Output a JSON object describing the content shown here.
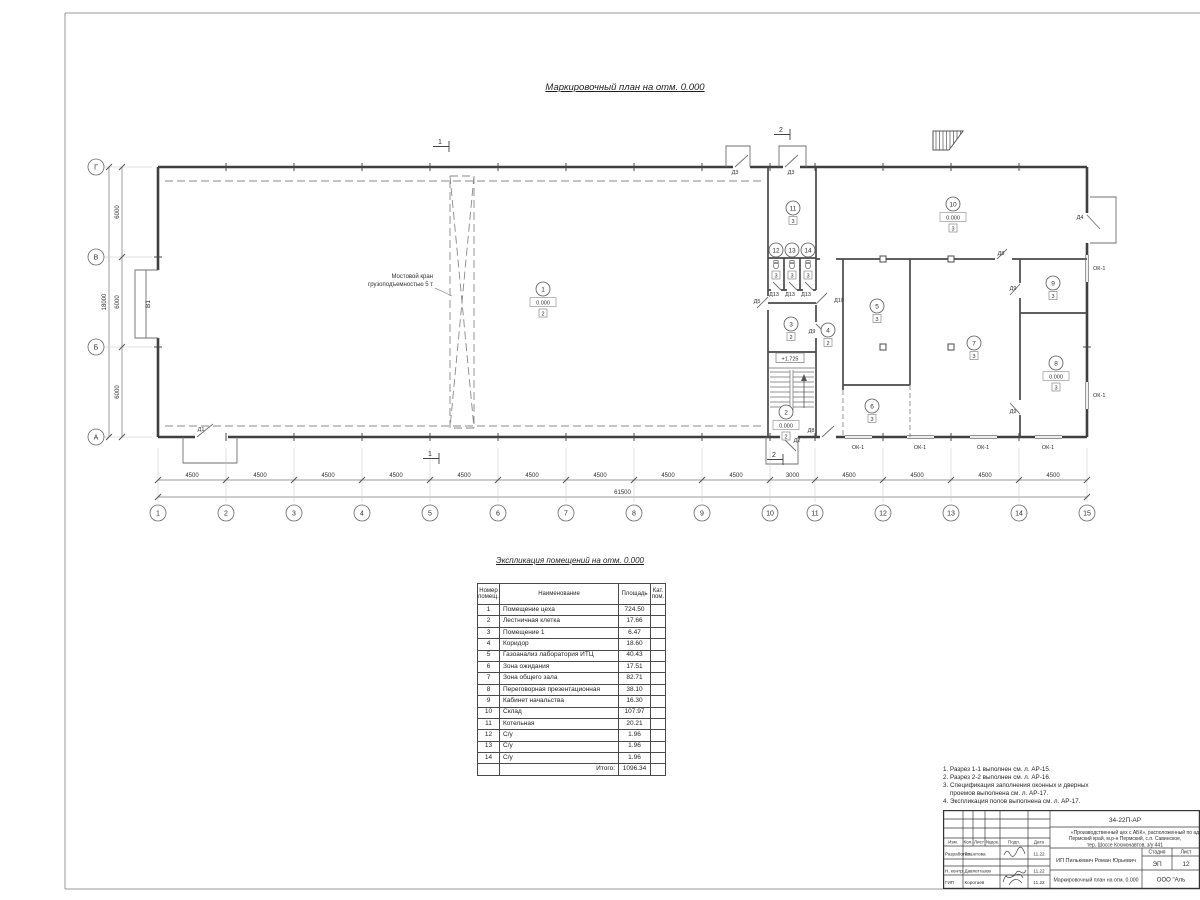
{
  "titles": {
    "plan_title": "Маркировочный план  на отм. 0.000",
    "table_title": "Экспликация помещений на отм. 0.000"
  },
  "plan": {
    "crane_label_lines": [
      "Мостовой кран",
      "грузоподъемностью 5 т"
    ],
    "level_mark": "+1.725",
    "gate_label": "В1",
    "grid_cols": [
      {
        "label": "1",
        "x": 158
      },
      {
        "label": "2",
        "x": 226
      },
      {
        "label": "3",
        "x": 294
      },
      {
        "label": "4",
        "x": 362
      },
      {
        "label": "5",
        "x": 430
      },
      {
        "label": "6",
        "x": 498
      },
      {
        "label": "7",
        "x": 566
      },
      {
        "label": "8",
        "x": 634
      },
      {
        "label": "9",
        "x": 702
      },
      {
        "label": "10",
        "x": 770
      },
      {
        "label": "11",
        "x": 815
      },
      {
        "label": "12",
        "x": 883
      },
      {
        "label": "13",
        "x": 951
      },
      {
        "label": "14",
        "x": 1019
      },
      {
        "label": "15",
        "x": 1087
      }
    ],
    "grid_rows": [
      {
        "label": "Г",
        "y": 167
      },
      {
        "label": "В",
        "y": 257
      },
      {
        "label": "Б",
        "y": 347
      },
      {
        "label": "А",
        "y": 437
      }
    ],
    "dim_bottom_segments": [
      "4500",
      "4500",
      "4500",
      "4500",
      "4500",
      "4500",
      "4500",
      "4500",
      "4500",
      "3000",
      "4500",
      "4500",
      "4500",
      "4500"
    ],
    "dim_bottom_total": "61500",
    "dim_left_segments": [
      "6000",
      "6000",
      "6000"
    ],
    "dim_left_total": "18000",
    "rooms": [
      {
        "n": "1",
        "x": 543,
        "y": 289,
        "elev": "0.000",
        "cat": "2"
      },
      {
        "n": "2",
        "x": 786,
        "y": 412,
        "elev": "0.000",
        "cat": "2"
      },
      {
        "n": "3",
        "x": 791,
        "y": 324,
        "cat": "2"
      },
      {
        "n": "4",
        "x": 828,
        "y": 330,
        "cat": "2"
      },
      {
        "n": "5",
        "x": 877,
        "y": 306,
        "cat": "3"
      },
      {
        "n": "6",
        "x": 872,
        "y": 406,
        "cat": "3"
      },
      {
        "n": "7",
        "x": 974,
        "y": 343,
        "cat": "3"
      },
      {
        "n": "8",
        "x": 1056,
        "y": 363,
        "elev": "0.000",
        "cat": "3"
      },
      {
        "n": "9",
        "x": 1053,
        "y": 283,
        "cat": "3"
      },
      {
        "n": "10",
        "x": 953,
        "y": 204,
        "elev": "0.000",
        "cat": "3"
      },
      {
        "n": "11",
        "x": 793,
        "y": 208,
        "cat": "3"
      },
      {
        "n": "12",
        "x": 776,
        "y": 250,
        "cat": "3",
        "wc": true
      },
      {
        "n": "13",
        "x": 792,
        "y": 250,
        "cat": "3",
        "wc": true
      },
      {
        "n": "14",
        "x": 808,
        "y": 250,
        "cat": "3",
        "wc": true
      }
    ],
    "doors": [
      {
        "t": "Д1",
        "x": 201,
        "y": 431
      },
      {
        "t": "Д3",
        "x": 735,
        "y": 174
      },
      {
        "t": "Д3",
        "x": 791,
        "y": 174
      },
      {
        "t": "Д4",
        "x": 1080,
        "y": 219
      },
      {
        "t": "Д5",
        "x": 757,
        "y": 303
      },
      {
        "t": "Д8",
        "x": 1001,
        "y": 255
      },
      {
        "t": "Д8",
        "x": 811,
        "y": 432
      },
      {
        "t": "Д9",
        "x": 812,
        "y": 333
      },
      {
        "t": "Д9",
        "x": 1013,
        "y": 290
      },
      {
        "t": "Д9",
        "x": 1013,
        "y": 413
      },
      {
        "t": "Д10",
        "x": 839,
        "y": 302
      },
      {
        "t": "Д13",
        "x": 774,
        "y": 296
      },
      {
        "t": "Д13",
        "x": 790,
        "y": 296
      },
      {
        "t": "Д13",
        "x": 806,
        "y": 296
      },
      {
        "t": "Д2",
        "x": 797,
        "y": 442
      }
    ],
    "windows": [
      {
        "t": "ОК-1",
        "x": 858,
        "y": 449,
        "a": "m"
      },
      {
        "t": "ОК-1",
        "x": 920,
        "y": 449,
        "a": "m"
      },
      {
        "t": "ОК-1",
        "x": 983,
        "y": 449,
        "a": "m"
      },
      {
        "t": "ОК-1",
        "x": 1048,
        "y": 449,
        "a": "m"
      },
      {
        "t": "ОК-1",
        "x": 1093,
        "y": 270,
        "a": "s"
      },
      {
        "t": "ОК-1",
        "x": 1093,
        "y": 397,
        "a": "s"
      }
    ],
    "sections": [
      {
        "n": "1",
        "x": 440,
        "y": 144
      },
      {
        "n": "1",
        "x": 430,
        "y": 456
      },
      {
        "n": "2",
        "x": 781,
        "y": 132
      },
      {
        "n": "2",
        "x": 774,
        "y": 457
      }
    ]
  },
  "table": {
    "headers": [
      "Номер помещ.",
      "Наименование",
      "Площадь",
      "Кат. пом."
    ],
    "rows": [
      [
        "1",
        "Помещение цеха",
        "724.50",
        ""
      ],
      [
        "2",
        "Лестничная клетка",
        "17.66",
        ""
      ],
      [
        "3",
        "Помещение 1",
        "6.47",
        ""
      ],
      [
        "4",
        "Коридор",
        "18.60",
        ""
      ],
      [
        "5",
        "Газоанализ лаборатория ИТЦ",
        "40.43",
        ""
      ],
      [
        "6",
        "Зона ожидания",
        "17.51",
        ""
      ],
      [
        "7",
        "Зона общего зала",
        "82.71",
        ""
      ],
      [
        "8",
        "Переговорная презентационная",
        "38.10",
        ""
      ],
      [
        "9",
        "Кабинет начальства",
        "16.30",
        ""
      ],
      [
        "10",
        "Склад",
        "107.97",
        ""
      ],
      [
        "11",
        "Котельная",
        "20.21",
        ""
      ],
      [
        "12",
        "С/у",
        "1.96",
        ""
      ],
      [
        "13",
        "С/у",
        "1.96",
        ""
      ],
      [
        "14",
        "С/у",
        "1.96",
        ""
      ]
    ],
    "total_label": "Итого:",
    "total_value": "1096.34"
  },
  "notes": [
    "1. Разрез 1-1 выполнен см. л. АР-15.",
    "2. Разрез 2-2 выполнен см. л. АР-16.",
    "3. Спецификация заполнения оконных и дверных",
    "    проемов выполнена см. л. АР-17.",
    "4. Экспликация полов выполнена см. л. АР-17."
  ],
  "titleblock": {
    "doc_number": "34-22П-АР",
    "address_lines": [
      "«Производственный цех с АБК», расположенный по ад",
      "Пермский край, м.р-н Пермский, с.п. Савинское,",
      "тер. Шоссе Космонавтов, з/у 441"
    ],
    "cols": [
      "Изм.",
      "Кол.",
      "Лист",
      "№док.",
      "Подп.",
      "Дата"
    ],
    "sign_rows": [
      {
        "role": "Разработал",
        "name": "Решетова",
        "date": "11.22"
      },
      {
        "role": "Н. контр.",
        "name": "Давлетгазов",
        "date": "11.22"
      },
      {
        "role": "ГИП",
        "name": "Коротаев",
        "date": "11.22"
      }
    ],
    "client": "ИП Пилькевич Роман Юрьевич",
    "stage_label": "Стадия",
    "sheet_label": "Лист",
    "stage": "ЭП",
    "sheet_num": "12",
    "doc_title": "Маркировочный план на отм. 0.000",
    "company": "ООО \"Аль"
  }
}
